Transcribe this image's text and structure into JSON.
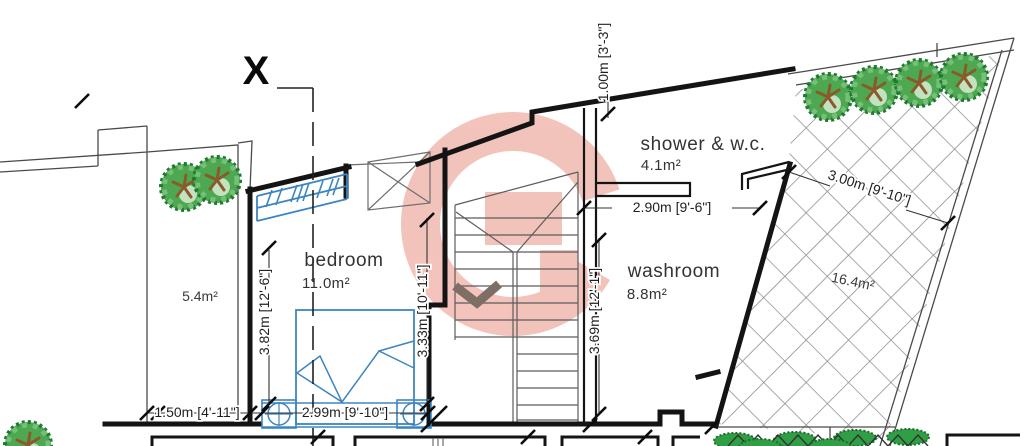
{
  "plan": {
    "section_label": "X",
    "rooms": {
      "bedroom": {
        "name": "bedroom",
        "area": "11.0m²"
      },
      "shower_wc": {
        "name": "shower & w.c.",
        "area": "4.1m²"
      },
      "washroom": {
        "name": "washroom",
        "area": "8.8m²"
      }
    },
    "terraces": {
      "left": {
        "area": "5.4m²"
      },
      "right": {
        "area": "16.4m²"
      }
    },
    "dimensions": {
      "planter_width": "1.50m [4'-11\"]",
      "bedroom_window_width": "2.99m [9'-10\"]",
      "bedroom_depth_left": "3.82m [12'-6\"]",
      "bedroom_depth_right": "3.33m [10'-11\"]",
      "washroom_depth": "3.69m [12'-1\"]",
      "shower_width": "2.90m [9'-6\"]",
      "stair_offset": "1.00m [3'-3\"]",
      "terrace_width": "3.00m [9'-10\"]"
    },
    "colors": {
      "wall_line": "#141414",
      "hatch_line": "#8f8f8f",
      "furniture_blue": "#3d85c0",
      "tree_green": "#4ea852",
      "watermark_salmon": "#e06a58"
    }
  }
}
